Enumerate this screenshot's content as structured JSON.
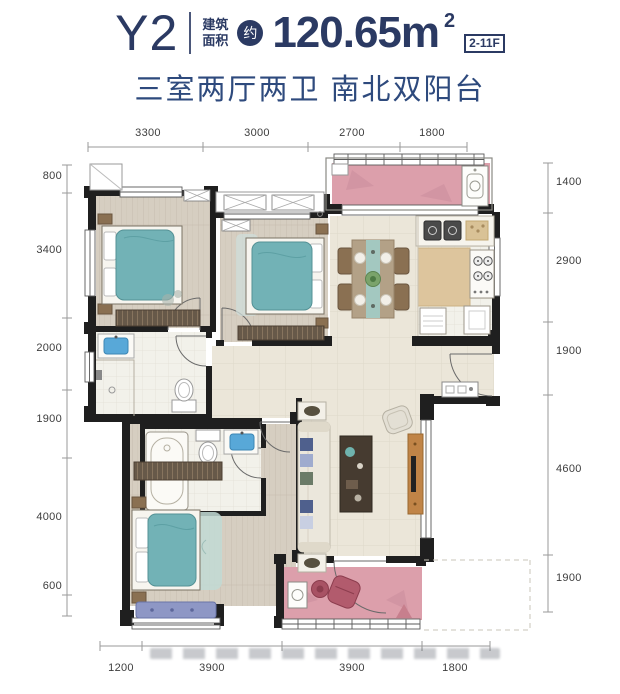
{
  "header": {
    "unit_name": "Y2",
    "area_label_line1": "建筑",
    "area_label_line2": "面积",
    "approx_badge": "约",
    "area_value": "120.65m",
    "area_exponent": "2",
    "floor_range": "2-11F",
    "subtitle": "三室两厅两卫 南北双阳台"
  },
  "colors": {
    "title_navy": "#2b3a63",
    "subtitle_blue": "#2e4a7d",
    "balcony_pink": "#dc9fab",
    "bed_teal": "#72b2b6",
    "bay_cushion_blue": "#8e97c5",
    "wood_cabinet": "#c08447",
    "wall_black": "#1f1f1f"
  },
  "dimensions": {
    "top": [
      "3300",
      "3000",
      "2700",
      "1800"
    ],
    "bottom": [
      "1200",
      "3900",
      "3900",
      "1800"
    ],
    "left": [
      "800",
      "3400",
      "2000",
      "1900",
      "4000",
      "600"
    ],
    "right": [
      "1400",
      "2900",
      "1900",
      "4600",
      "1900"
    ]
  }
}
